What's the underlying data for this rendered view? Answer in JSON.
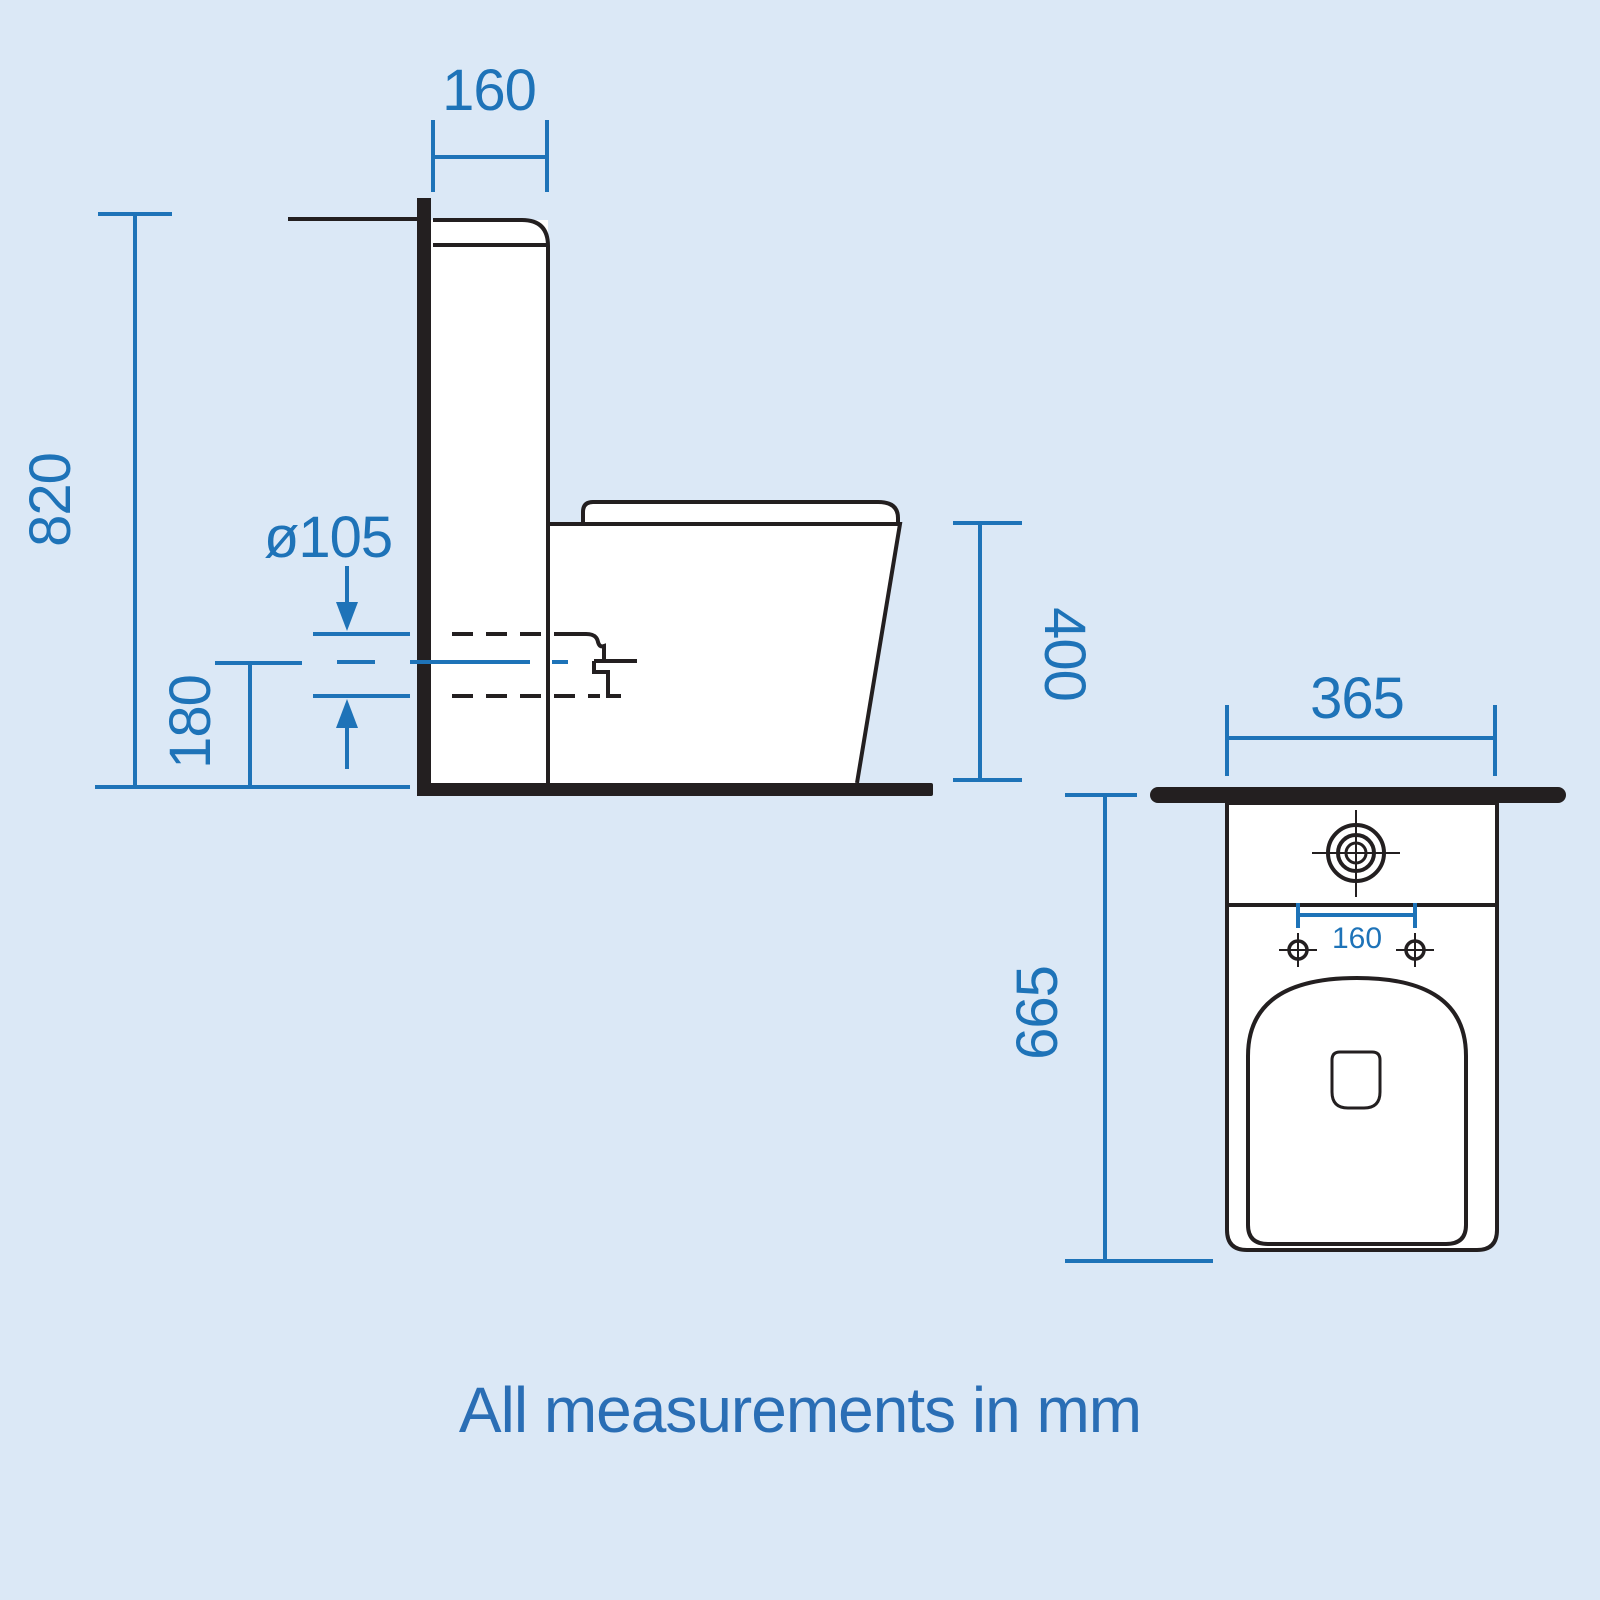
{
  "note": "All measurements in mm",
  "colors": {
    "background": "#dbe8f6",
    "dimension_blue": "#1e73b8",
    "drawing_black": "#231f20",
    "ceramic_white": "#ffffff"
  },
  "side_view": {
    "cistern_depth": "160",
    "total_height": "820",
    "outlet_diameter": "ø105",
    "outlet_centre_height": "180",
    "pan_height": "400"
  },
  "plan_view": {
    "pan_width": "365",
    "pan_depth": "665",
    "fixing_hole_centres": "160"
  }
}
